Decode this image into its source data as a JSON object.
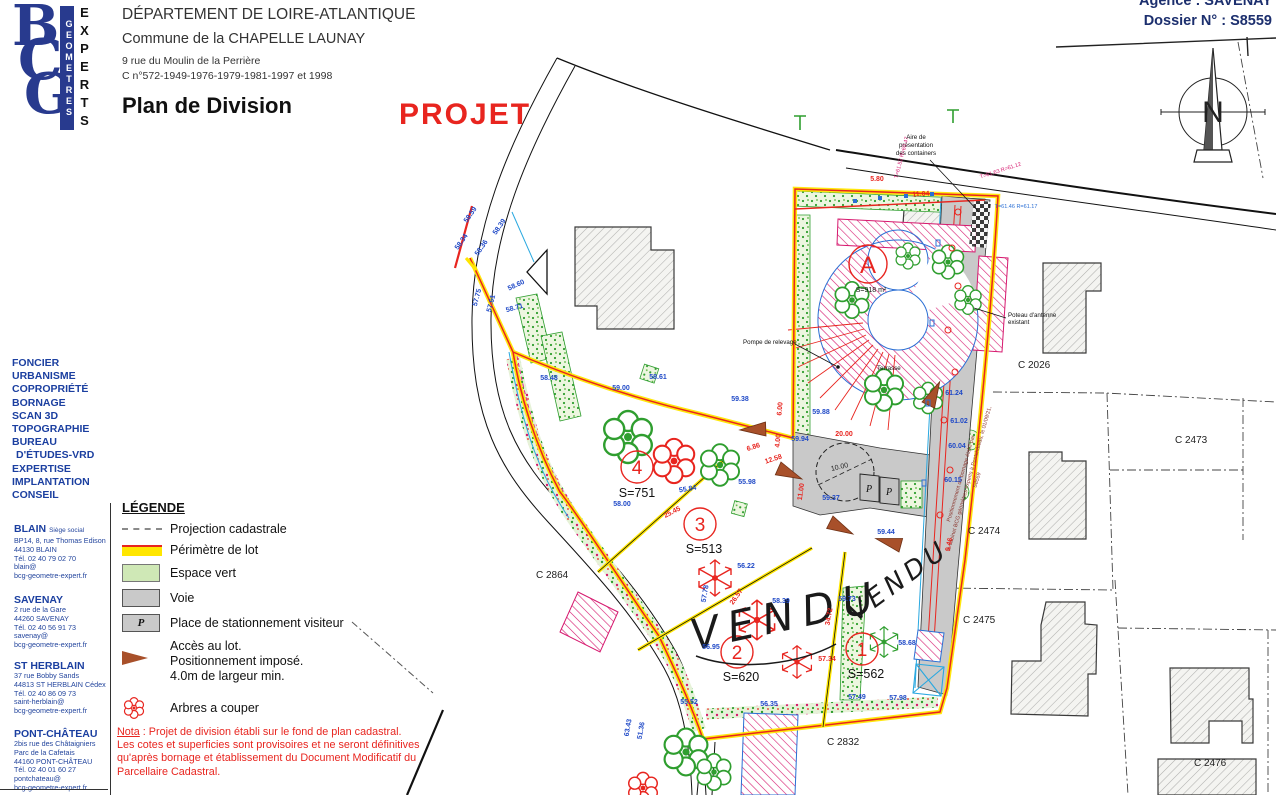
{
  "header": {
    "department": "DÉPARTEMENT DE LOIRE-ATLANTIQUE",
    "commune": "Commune de la CHAPELLE LAUNAY",
    "address": "9 rue du Moulin de la Perrière",
    "cadastral_refs": "C n°572-1949-1976-1979-1981-1997 et 1998",
    "title": "Plan de Division",
    "stamp": "PROJET",
    "agency": "Agence : SAVENAY",
    "dossier": "Dossier N° : S8559"
  },
  "logo": {
    "letters": [
      "B",
      "C",
      "G"
    ],
    "vertical_left": "GEOMETRES",
    "vertical_right": "EXPERTS"
  },
  "sidebar": {
    "services": [
      "FONCIER",
      "URBANISME",
      "COPROPRIÉTÉ",
      "BORNAGE",
      "SCAN 3D",
      "TOPOGRAPHIE",
      "BUREAU",
      "D'ÉTUDES-VRD",
      "EXPERTISE",
      "IMPLANTATION",
      "CONSEIL"
    ],
    "offices": [
      {
        "name": "BLAIN",
        "tag": "Siège social",
        "lines": [
          "BP14, 8, rue Thomas Edison",
          "44130 BLAIN",
          "Tél. 02 40 79 02 70",
          "blain@",
          "bcg-geometre-expert.fr"
        ]
      },
      {
        "name": "SAVENAY",
        "tag": "",
        "lines": [
          "2 rue de la Gare",
          "44260 SAVENAY",
          "Tél. 02 40 56 91 73",
          "savenay@",
          "bcg-geometre-expert.fr"
        ]
      },
      {
        "name": "ST HERBLAIN",
        "tag": "",
        "lines": [
          "37 rue Bobby Sands",
          "44813 ST HERBLAIN Cédex",
          "Tél. 02 40 86 09 73",
          "saint-herblain@",
          "bcg-geometre-expert.fr"
        ]
      },
      {
        "name": "PONT-CHÂTEAU",
        "tag": "",
        "lines": [
          "2bis rue des Châtaigniers",
          "Parc de la Cafetais",
          "44160 PONT-CHÂTEAU",
          "Tél. 02 40 01 60 27",
          "pontchateau@",
          "bcg-geometre-expert.fr"
        ]
      }
    ]
  },
  "legend": {
    "title": "LÉGENDE",
    "projection": "Projection cadastrale",
    "perimetre": "Périmètre de lot",
    "espace": "Espace vert",
    "voie": "Voie",
    "stationnement": "Place de stationnement visiteur",
    "acces": [
      "Accès au lot.",
      "Positionnement imposé.",
      "4.0m de largeur min."
    ],
    "arbres": "Arbres a couper",
    "p": "P"
  },
  "nota": {
    "label": "Nota",
    "line1": " : Projet de division établi sur le fond de plan cadastral.",
    "line2": "Les cotes et superficies sont provisoires et ne seront définitives",
    "line3": "qu'après bornage et établissement du Document Modificatif du",
    "line4": "Parcellaire Cadastral."
  },
  "map": {
    "lots": [
      {
        "num": "4",
        "surface": "S=751"
      },
      {
        "num": "3",
        "surface": "S=513"
      },
      {
        "num": "2",
        "surface": "S=620"
      },
      {
        "num": "1",
        "surface": "S=562"
      },
      {
        "num": "A",
        "surface": "S=918 m²"
      }
    ],
    "parcels": [
      "C 2026",
      "C 2473",
      "C 2474",
      "C 2475",
      "C 2476",
      "C 2832",
      "C 2864"
    ],
    "vendu": "VENDU",
    "p": "P",
    "labels": {
      "containers": [
        "Aire de",
        "présentation",
        "des containers"
      ],
      "pompe": "Pompe de relevage",
      "terrasse": "Terrasse",
      "poteau": [
        "Poteau d'antenne",
        "existant"
      ],
      "bornage_note": [
        "Positionnement du bornage établi par",
        "le cabinet BCG géomètres experts à Pontchâteau, le 01/09/21,",
        "S8559"
      ],
      "north": "N"
    },
    "measurements": [
      "58.59",
      "58.34",
      "58.36",
      "58.39",
      "58.60",
      "58.71",
      "57.75",
      "57.61",
      "58.48",
      "59.00",
      "58.61",
      "59.38",
      "58.00",
      "55.84",
      "55.98",
      "25.45",
      "6.86",
      "12.58",
      "57.78",
      "56.22",
      "11.00",
      "58.39",
      "59.73",
      "34.72",
      "57.34",
      "58.68",
      "56.95",
      "55.52",
      "56.35",
      "57.49",
      "57.98",
      "26.57",
      "10.00",
      "20.00",
      "59.88",
      "59.94",
      "61.24",
      "61.02",
      "60.04",
      "60.15",
      "9.46",
      "6.00",
      "4.00",
      "5.80",
      "11.04",
      "T=61.52 R=60.47",
      "T=61.46 R=61.17",
      "T=61.63 R=61.12",
      "63.43",
      "51.36",
      "59.37",
      "59.44"
    ]
  },
  "colors": {
    "perimeter_yellow": "#ffe600",
    "perimeter_red": "#e8251f",
    "measure_blue": "#1f49c7",
    "hatch_magenta": "#d6186e",
    "green": "#2f9e2f",
    "voie_gray": "#c9c9c9",
    "access_brown": "#a8502a",
    "brand_blue": "#283a8e"
  }
}
